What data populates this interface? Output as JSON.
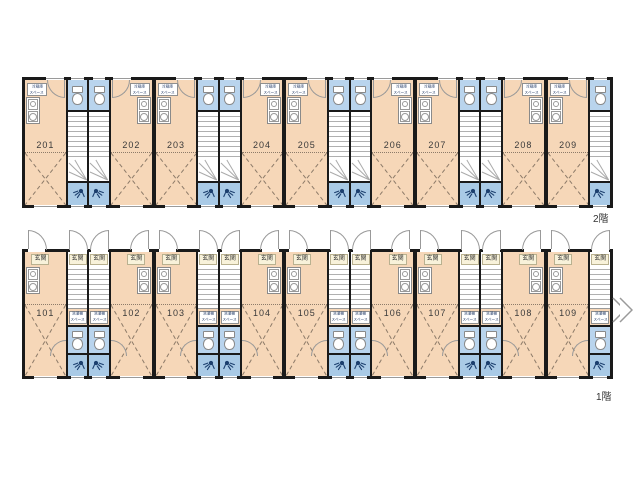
{
  "floor2": {
    "floor_label": "2階",
    "appliance_note": "冷蔵庫スペース",
    "cells": [
      {
        "type": "room",
        "number": "201",
        "kitchen": "left",
        "wall": "none",
        "appl": {
          "l1": "冷蔵庫",
          "l2": "スペース"
        }
      },
      {
        "type": "strip",
        "wall": "thin",
        "hinge": "l"
      },
      {
        "type": "strip",
        "wall": "thin",
        "hinge": "r"
      },
      {
        "type": "room",
        "number": "202",
        "kitchen": "right",
        "wall": "thin",
        "appl": {
          "l1": "冷蔵庫",
          "l2": "スペース"
        }
      },
      {
        "type": "room",
        "number": "203",
        "kitchen": "left",
        "wall": "thick",
        "appl": {
          "l1": "冷蔵庫",
          "l2": "スペース"
        }
      },
      {
        "type": "strip",
        "wall": "thin",
        "hinge": "l"
      },
      {
        "type": "strip",
        "wall": "thin",
        "hinge": "r"
      },
      {
        "type": "room",
        "number": "204",
        "kitchen": "right",
        "wall": "thin",
        "appl": {
          "l1": "冷蔵庫",
          "l2": "スペース"
        }
      },
      {
        "type": "room",
        "number": "205",
        "kitchen": "left",
        "wall": "thick",
        "appl": {
          "l1": "冷蔵庫",
          "l2": "スペース"
        }
      },
      {
        "type": "strip",
        "wall": "thin",
        "hinge": "l"
      },
      {
        "type": "strip",
        "wall": "thin",
        "hinge": "r"
      },
      {
        "type": "room",
        "number": "206",
        "kitchen": "right",
        "wall": "thin",
        "appl": {
          "l1": "冷蔵庫",
          "l2": "スペース"
        }
      },
      {
        "type": "room",
        "number": "207",
        "kitchen": "left",
        "wall": "thick",
        "appl": {
          "l1": "冷蔵庫",
          "l2": "スペース"
        }
      },
      {
        "type": "strip",
        "wall": "thin",
        "hinge": "l"
      },
      {
        "type": "strip",
        "wall": "thin",
        "hinge": "r"
      },
      {
        "type": "room",
        "number": "208",
        "kitchen": "right",
        "wall": "thin",
        "appl": {
          "l1": "冷蔵庫",
          "l2": "スペース"
        }
      },
      {
        "type": "room",
        "number": "209",
        "kitchen": "left",
        "wall": "thick",
        "appl": {
          "l1": "冷蔵庫",
          "l2": "スペース"
        }
      },
      {
        "type": "strip",
        "wall": "thin",
        "hinge": "r"
      }
    ]
  },
  "floor1": {
    "floor_label": "1階",
    "appliance_note": "洗濯機スペース",
    "cells": [
      {
        "type": "room",
        "number": "101",
        "kitchen": "left",
        "wall": "none",
        "entrance": "玄関"
      },
      {
        "type": "strip",
        "wall": "thin",
        "hinge": "l",
        "entrance": "玄関",
        "appl": {
          "l1": "洗濯機",
          "l2": "スペース"
        }
      },
      {
        "type": "strip",
        "wall": "thin",
        "hinge": "r",
        "entrance": "玄関",
        "appl": {
          "l1": "洗濯機",
          "l2": "スペース"
        }
      },
      {
        "type": "room",
        "number": "102",
        "kitchen": "right",
        "wall": "thin",
        "entrance": "玄関"
      },
      {
        "type": "room",
        "number": "103",
        "kitchen": "left",
        "wall": "thick",
        "entrance": "玄関"
      },
      {
        "type": "strip",
        "wall": "thin",
        "hinge": "l",
        "entrance": "玄関",
        "appl": {
          "l1": "洗濯機",
          "l2": "スペース"
        }
      },
      {
        "type": "strip",
        "wall": "thin",
        "hinge": "r",
        "entrance": "玄関",
        "appl": {
          "l1": "洗濯機",
          "l2": "スペース"
        }
      },
      {
        "type": "room",
        "number": "104",
        "kitchen": "right",
        "wall": "thin",
        "entrance": "玄関"
      },
      {
        "type": "room",
        "number": "105",
        "kitchen": "left",
        "wall": "thick",
        "entrance": "玄関"
      },
      {
        "type": "strip",
        "wall": "thin",
        "hinge": "l",
        "entrance": "玄関",
        "appl": {
          "l1": "洗濯機",
          "l2": "スペース"
        }
      },
      {
        "type": "strip",
        "wall": "thin",
        "hinge": "r",
        "entrance": "玄関",
        "appl": {
          "l1": "洗濯機",
          "l2": "スペース"
        }
      },
      {
        "type": "room",
        "number": "106",
        "kitchen": "right",
        "wall": "thin",
        "entrance": "玄関"
      },
      {
        "type": "room",
        "number": "107",
        "kitchen": "left",
        "wall": "thick",
        "entrance": "玄関"
      },
      {
        "type": "strip",
        "wall": "thin",
        "hinge": "l",
        "entrance": "玄関",
        "appl": {
          "l1": "洗濯機",
          "l2": "スペース"
        }
      },
      {
        "type": "strip",
        "wall": "thin",
        "hinge": "r",
        "entrance": "玄関",
        "appl": {
          "l1": "洗濯機",
          "l2": "スペース"
        }
      },
      {
        "type": "room",
        "number": "108",
        "kitchen": "right",
        "wall": "thin",
        "entrance": "玄関"
      },
      {
        "type": "room",
        "number": "109",
        "kitchen": "left",
        "wall": "thick",
        "entrance": "玄関"
      },
      {
        "type": "strip",
        "wall": "thin",
        "hinge": "r",
        "entrance": "玄関",
        "appl": {
          "l1": "洗濯機",
          "l2": "スペース"
        }
      }
    ]
  },
  "icons": {
    "toilet-icon": "css shape: tank rectangle + oval bowl",
    "shower-icon": "svg: filled head circle + spray lines + hose",
    "kitchen-unit-icon": "css: sink square with faucet circle + stove ring",
    "door-arc-icon": "css quarter-circle swing arc",
    "stairs": "repeating horizontal tread lines + winder diagonals",
    "right-chevron-icon": "svg double chevron pointing right"
  },
  "colors": {
    "room_fill": "#f6d7b8",
    "toilet_fill": "#b9d4ed",
    "shower_fill": "#a9cae6",
    "wall": "#1a1a1a",
    "entrance_label_bg": "#f8f2da",
    "appliance_text": "#223a66",
    "dash_lines": "#8d7b69"
  }
}
